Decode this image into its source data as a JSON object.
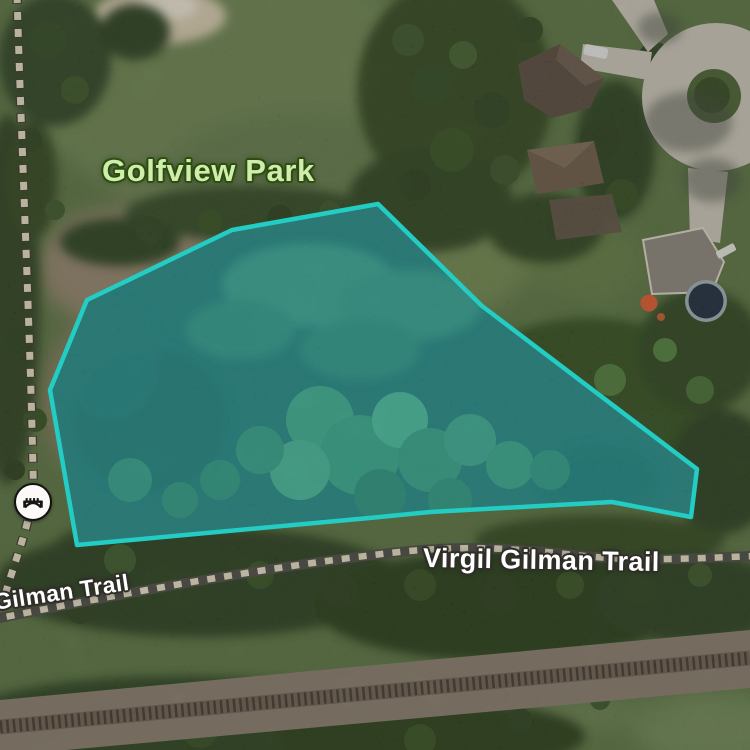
{
  "map": {
    "park_label": "Golfview Park",
    "trail_label_main": "Virgil Gilman Trail",
    "trail_label_secondary": "Gilman Trail",
    "bridge_poi": {
      "icon": "bridge-icon"
    },
    "highlight": {
      "polygon_points": "378,204 482,306 697,469 691,517 612,502 430,512 380,517 77,545 50,390 87,300 232,230",
      "stroke_color": "#23CDC4",
      "fill_color": "rgba(44,210,200,0.26)"
    },
    "colors": {
      "park_label_fill": "#CFEEAB",
      "park_label_halo": "#2C4C10",
      "trail_label_fill": "#FFFFFF",
      "trail_label_halo": "#2F2E28",
      "trail_dash": "#E9E0C4",
      "trail_asphalt": "#4C4B43",
      "railroad_gravel": "#8A7E6C",
      "vegetation_base": "#5A7440",
      "pond_water": "#236361",
      "culdesac_pavement": "#CDC7B8"
    }
  }
}
